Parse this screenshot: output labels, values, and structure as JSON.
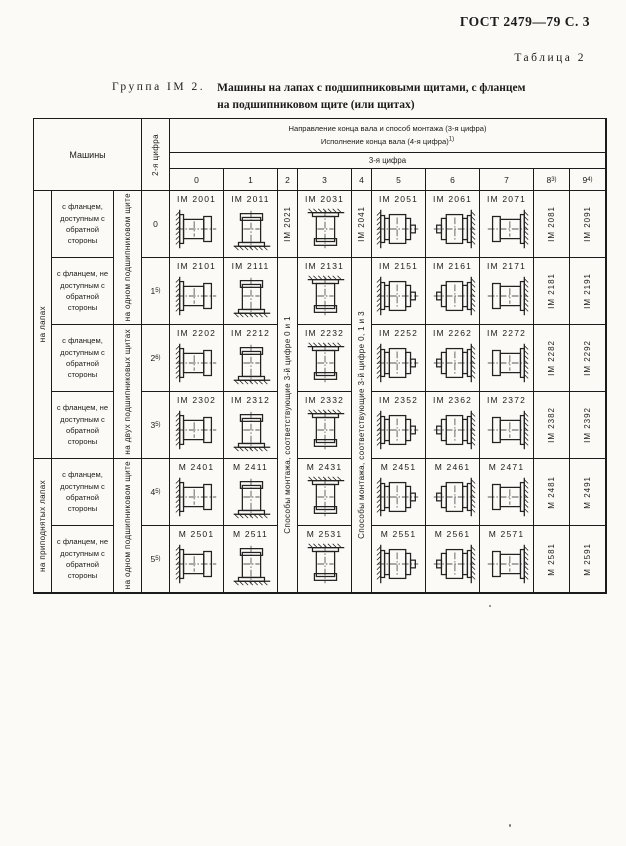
{
  "page": {
    "gost": "ГОСТ 2479—79 С. 3",
    "table_label": "Таблица 2",
    "group_label": "Группа IM 2.",
    "title_line1": "Машины на лапах с подшипниковыми щитами, с фланцем",
    "title_line2": "на подшипниковом щите (или щитах)"
  },
  "table": {
    "header": {
      "machines": "Машины",
      "digit2": "2-я цифра",
      "line1": "Направление конца вала и способ монтажа (3-я цифра)",
      "line2": "Исполнение конца вала (4-я цифра)",
      "line2_sup": "1)",
      "digit3": "3-я цифра",
      "cols": [
        {
          "d": "0",
          "sup": ""
        },
        {
          "d": "1",
          "sup": ""
        },
        {
          "d": "2",
          "sup": ""
        },
        {
          "d": "3",
          "sup": ""
        },
        {
          "d": "4",
          "sup": ""
        },
        {
          "d": "5",
          "sup": ""
        },
        {
          "d": "6",
          "sup": ""
        },
        {
          "d": "7",
          "sup": ""
        },
        {
          "d": "8",
          "sup": "3)"
        },
        {
          "d": "9",
          "sup": "4)"
        }
      ]
    },
    "side_groups": [
      {
        "label": "на лапах",
        "rows": 4
      },
      {
        "label": "на приподнятых лапах",
        "rows": 2
      }
    ],
    "shield_groups": [
      {
        "label": "на одном подшипниковом щите",
        "rows": 2
      },
      {
        "label": "на двух подшипниковых щитах",
        "rows": 2
      },
      {
        "label": "на одном подшипниковом щите",
        "rows": 2
      }
    ],
    "col2_span_text": "Способы монтажа, соответствующие 3-й цифре 0 и 1",
    "col4_span_text": "Способы монтажа, соответствующие 3-й цифре 0, 1 и 3",
    "drawing_variants": {
      "0": "flange-wall-left",
      "1": "flange-floor",
      "3": "flange-ceiling",
      "5": "flange-wall-left-double",
      "6": "flange-wall-right-double",
      "7": "flange-wall-right"
    },
    "rows": [
      {
        "desc": "с фланцем, доступным с обратной стороны",
        "digit": "0",
        "digit_sup": "",
        "codes": [
          "IM 2001",
          "IM 2011",
          "IM 2021",
          "IM 2031",
          "IM 2041",
          "IM 2051",
          "IM 2061",
          "IM 2071",
          "IM 2081",
          "IM 2091"
        ]
      },
      {
        "desc": "с фланцем, не доступным с обратной стороны",
        "digit": "1",
        "digit_sup": "5)",
        "codes": [
          "IM 2101",
          "IM 2111",
          null,
          "IM 2131",
          null,
          "IM 2151",
          "IM 2161",
          "IM 2171",
          "IM 2181",
          "IM 2191"
        ]
      },
      {
        "desc": "с фланцем, доступным с обратной стороны",
        "digit": "2",
        "digit_sup": "6)",
        "codes": [
          "IM 2202",
          "IM 2212",
          null,
          "IM 2232",
          null,
          "IM 2252",
          "IM 2262",
          "IM 2272",
          "IM 2282",
          "IM 2292"
        ]
      },
      {
        "desc": "с фланцем, не доступным с обратной стороны",
        "digit": "3",
        "digit_sup": "5)",
        "codes": [
          "IM 2302",
          "IM 2312",
          null,
          "IM 2332",
          null,
          "IM 2352",
          "IM 2362",
          "IM 2372",
          "IM 2382",
          "IM 2392"
        ]
      },
      {
        "desc": "с фланцем, доступным с обратной стороны",
        "digit": "4",
        "digit_sup": "5)",
        "codes": [
          "М 2401",
          "М 2411",
          null,
          "М 2431",
          null,
          "М 2451",
          "М 2461",
          "М 2471",
          "М 2481",
          "М 2491"
        ]
      },
      {
        "desc": "с фланцем, не доступным с обратной стороны",
        "digit": "5",
        "digit_sup": "5)",
        "codes": [
          "М 2501",
          "М 2511",
          null,
          "М 2531",
          null,
          "М 2551",
          "М 2561",
          "М 2571",
          "М 2581",
          "М 2591"
        ]
      }
    ]
  }
}
